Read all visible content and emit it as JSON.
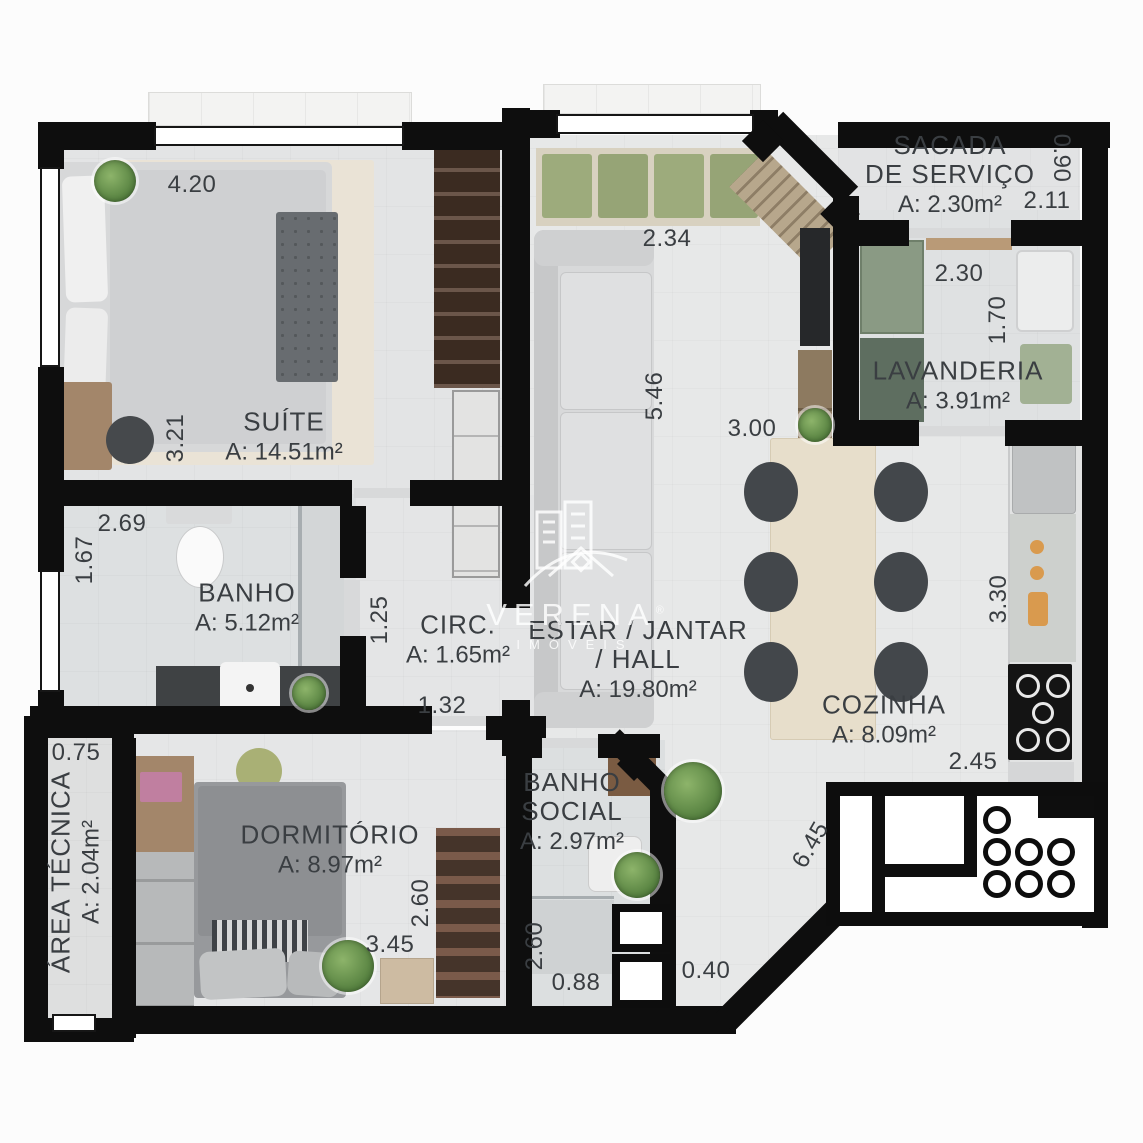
{
  "watermark": {
    "name": "VERENA",
    "reg": "®",
    "sub": "IMÓVEIS"
  },
  "rooms": {
    "suite": {
      "name": "SUÍTE",
      "area": "A: 14.51m²"
    },
    "sacada": {
      "line1": "SACADA",
      "line2": "DE SERVIÇO",
      "area": "A: 2.30m²"
    },
    "lavanderia": {
      "name": "LAVANDERIA",
      "area": "A: 3.91m²"
    },
    "banho": {
      "name": "BANHO",
      "area": "A: 5.12m²"
    },
    "circ": {
      "name": "CIRC.",
      "area": "A: 1.65m²"
    },
    "estar": {
      "line1": "ESTAR / JANTAR",
      "line2": "/ HALL",
      "area": "A: 19.80m²"
    },
    "cozinha": {
      "name": "COZINHA",
      "area": "A: 8.09m²"
    },
    "dormitorio": {
      "name": "DORMITÓRIO",
      "area": "A: 8.97m²"
    },
    "banho_social": {
      "line1": "BANHO",
      "line2": "SOCIAL",
      "area": "A: 2.97m²"
    },
    "area_tecnica": {
      "name": "ÁREA TÉCNICA",
      "area": "A: 2.04m²"
    }
  },
  "dims": {
    "suite_width": "4.20",
    "suite_depth": "3.21",
    "sacada_depth": "0.90",
    "sacada_width": "2.11",
    "lavanderia_width": "2.30",
    "lavanderia_depth": "1.70",
    "living_top": "2.34",
    "living_depth": "5.46",
    "living_width": "3.00",
    "banho_width": "2.69",
    "banho_depth": "1.67",
    "circ_depth": "1.25",
    "circ_width": "1.32",
    "cozinha_depth": "3.30",
    "cozinha_width": "2.45",
    "diagonal": "6.45",
    "area_tecnica_width": "0.75",
    "dorm_width": "3.45",
    "dorm_depth": "2.60",
    "banho_social_depth": "2.60",
    "banho_social_width": "0.88",
    "shaft_width": "0.40"
  }
}
